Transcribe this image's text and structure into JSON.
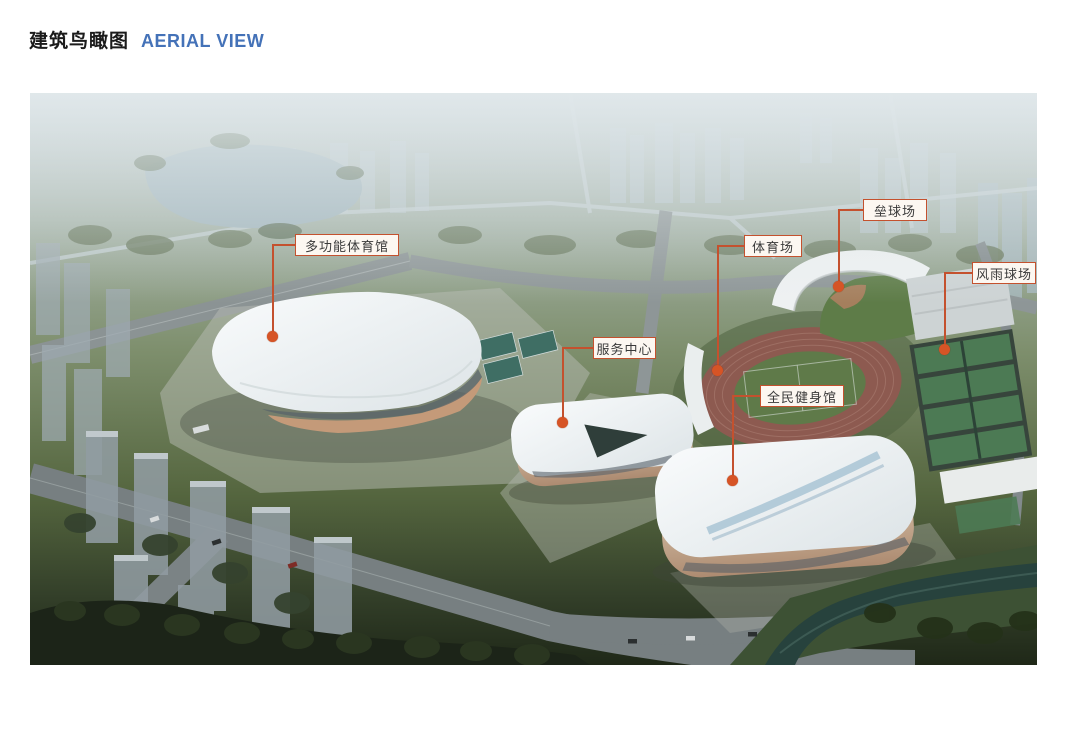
{
  "header": {
    "title_zh": "建筑鸟瞰图",
    "title_en": "AERIAL VIEW",
    "title_en_color": "#4472b8"
  },
  "figure": {
    "accent_color": "#c4512e",
    "callouts": [
      {
        "label": "多功能体育馆"
      },
      {
        "label": "垒球场"
      },
      {
        "label": "体育场"
      },
      {
        "label": "风雨球场"
      },
      {
        "label": "服务中心"
      },
      {
        "label": "全民健身馆"
      }
    ]
  }
}
